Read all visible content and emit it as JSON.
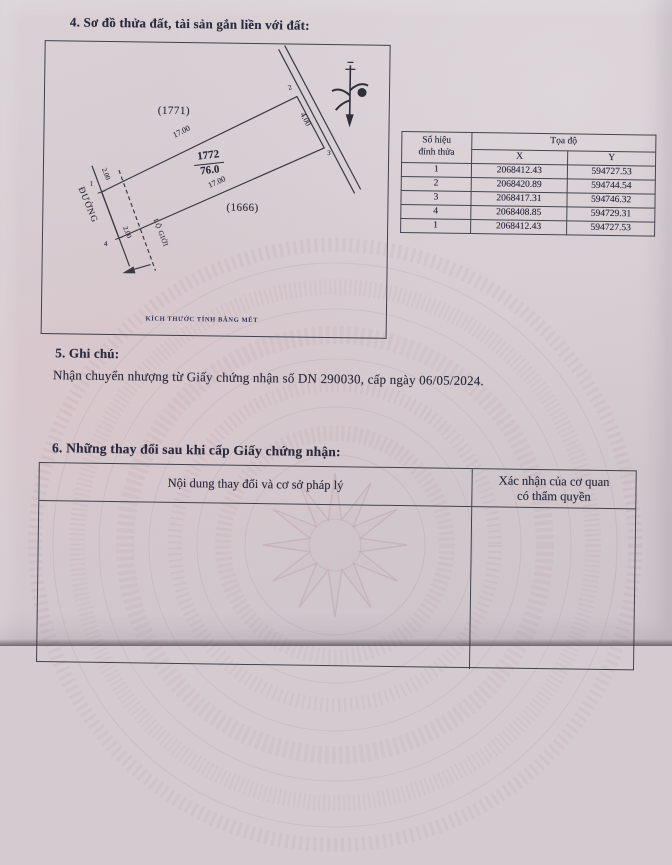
{
  "page": {
    "section4_title": "4. Sơ đồ thửa đất, tài sản gắn liền với đất:"
  },
  "diagram": {
    "neighbor_top": "(1771)",
    "neighbor_bottom": "(1666)",
    "plot_number": "1772",
    "area": "76.0",
    "edge_top": "17.00",
    "edge_bottom": "17.00",
    "edge_right": "4.00",
    "offset_top": "2.00",
    "offset_bottom": "2.00",
    "vertex_1": "1",
    "vertex_2": "2",
    "vertex_3": "3",
    "vertex_4": "4",
    "road_label": "ĐƯỜNG",
    "boundary_label": "LỘ GIỚI",
    "scale_note": "KÍCH THƯỚC TÍNH BẰNG MÉT"
  },
  "coords_table": {
    "col_vertex": "Số hiệu\nđỉnh thửa",
    "col_toado": "Tọa độ",
    "col_x": "X",
    "col_y": "Y",
    "rows": [
      {
        "v": "1",
        "x": "2068412.43",
        "y": "594727.53"
      },
      {
        "v": "2",
        "x": "2068420.89",
        "y": "594744.54"
      },
      {
        "v": "3",
        "x": "2068417.31",
        "y": "594746.32"
      },
      {
        "v": "4",
        "x": "2068408.85",
        "y": "594729.31"
      },
      {
        "v": "1",
        "x": "2068412.43",
        "y": "594727.53"
      }
    ]
  },
  "section5": {
    "heading": "5. Ghi chú:",
    "note": "Nhận chuyển nhượng từ Giấy chứng nhận số DN 290030, cấp ngày 06/05/2024."
  },
  "section6": {
    "heading": "6. Những thay đổi sau khi cấp Giấy chứng nhận:",
    "col_left": "Nội dung thay đổi và cơ sở pháp lý",
    "col_right": "Xác nhận của cơ quan\ncó thẩm quyền"
  },
  "colors": {
    "ink": "#2a2a3c",
    "paper": "#d4cbd0",
    "watermark": "#a97f8c"
  }
}
